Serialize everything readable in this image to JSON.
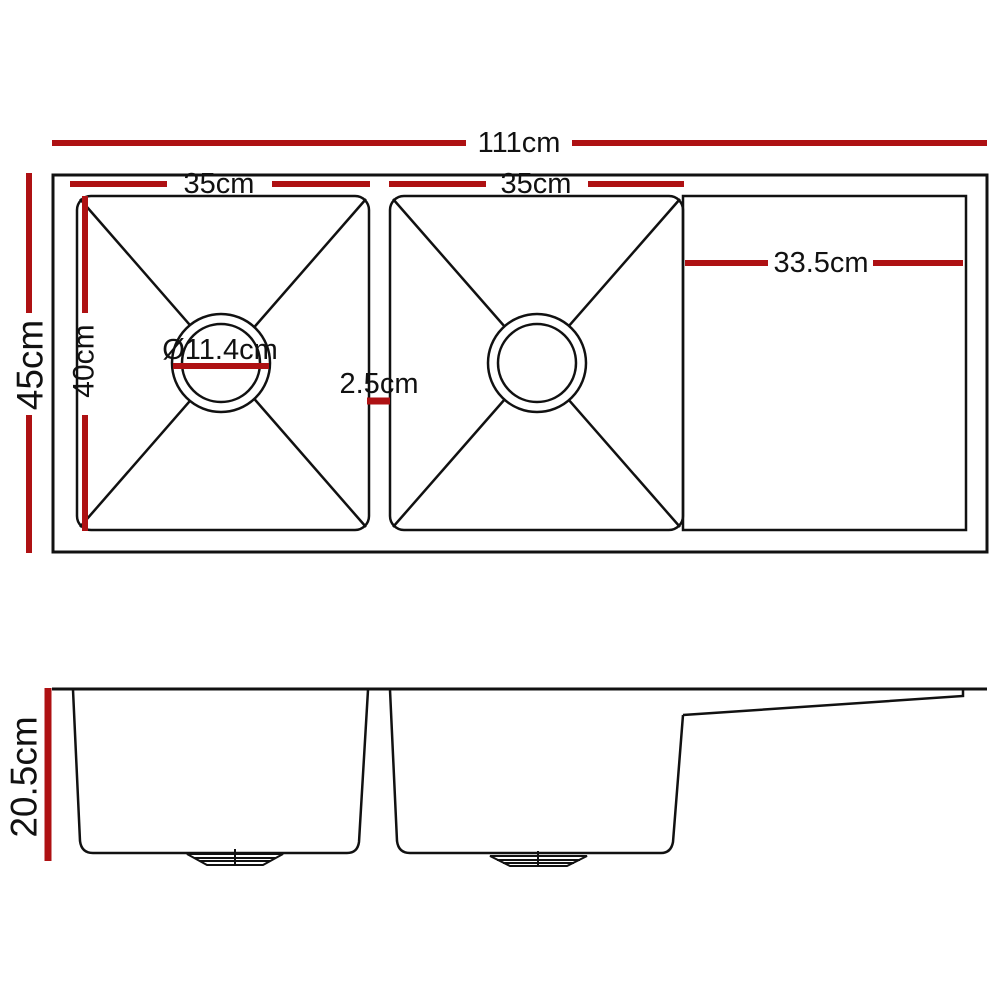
{
  "diagram": {
    "type": "sink-dimension-drawing",
    "colors": {
      "dimension_red": "#ae1113",
      "line_black": "#111111",
      "background": "#ffffff"
    },
    "top_view": {
      "dimensions": {
        "overall_width": "111cm",
        "overall_depth": "45cm",
        "left_bowl_width": "35cm",
        "right_bowl_width": "35cm",
        "bowl_inner_depth": "40cm",
        "drain_diameter": "Ø11.4cm",
        "divider_gap": "2.5cm",
        "drainer_width": "33.5cm"
      }
    },
    "side_view": {
      "dimensions": {
        "bowl_depth": "20.5cm"
      }
    }
  }
}
